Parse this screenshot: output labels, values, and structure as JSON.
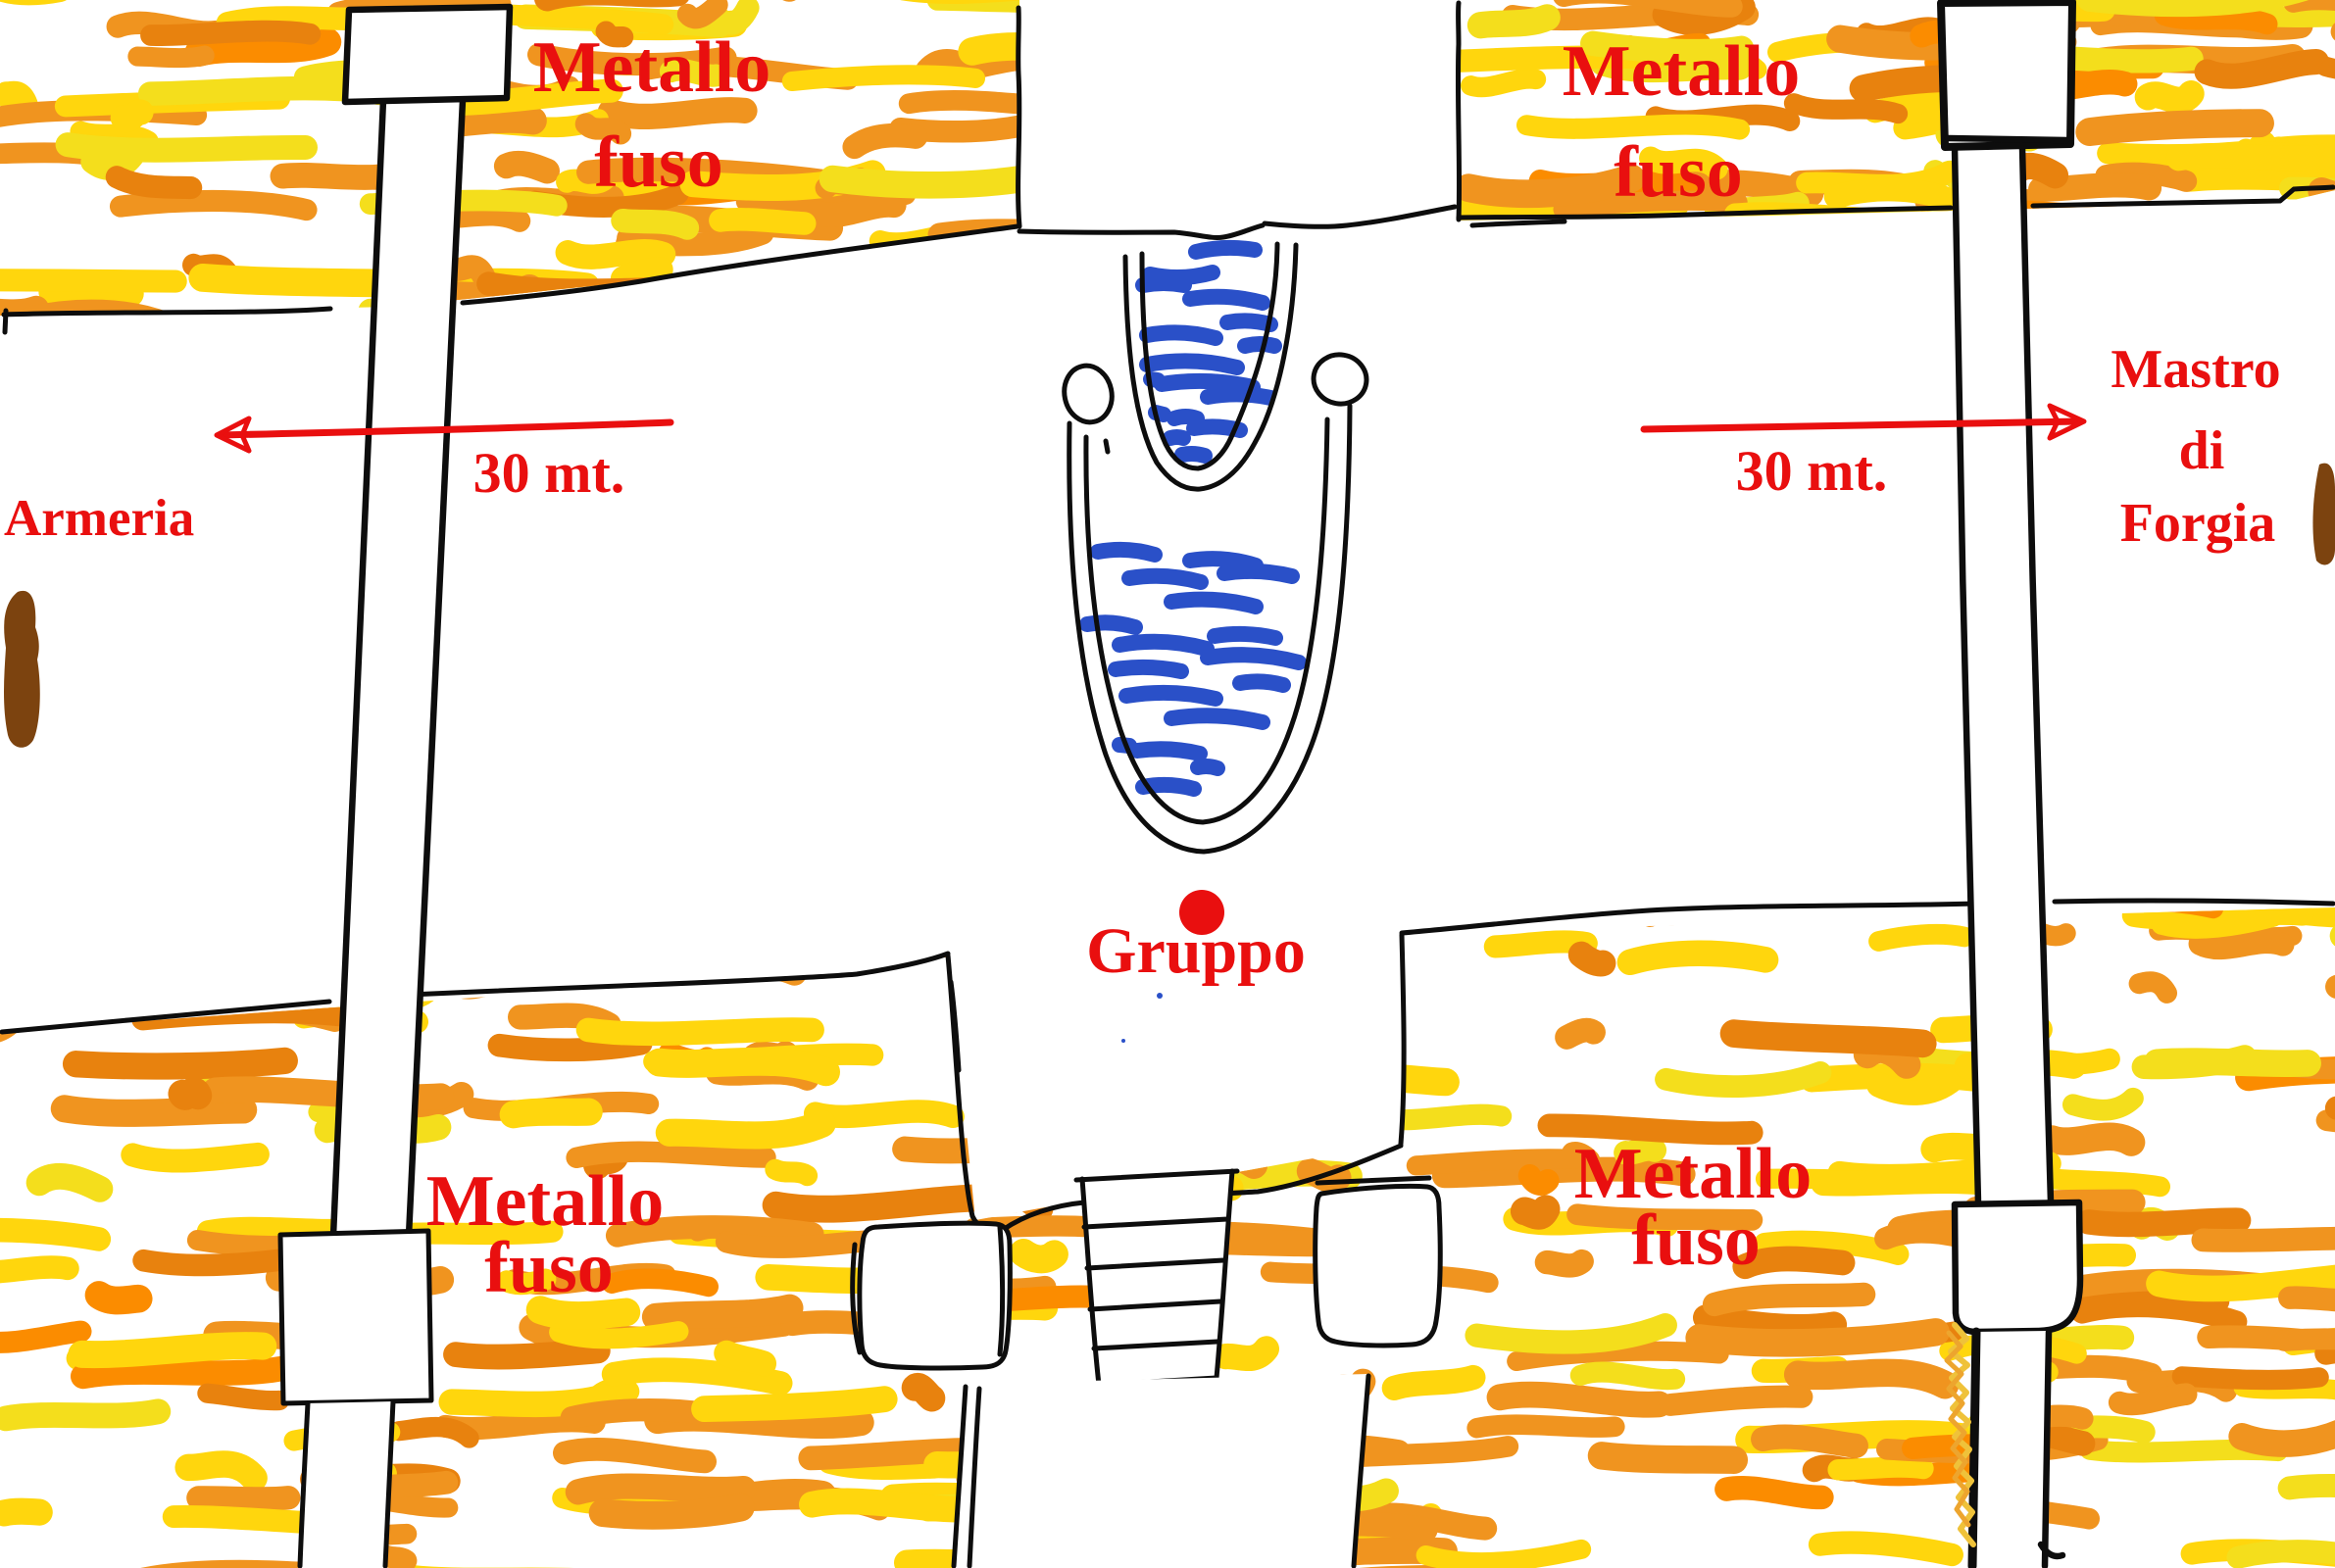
{
  "map": {
    "molten_label": {
      "line1": "Metallo",
      "line2": "fuso"
    },
    "armory_label": "Armeria",
    "forge_master_label": {
      "line1": "Mastro",
      "line2": "di",
      "line3": "Forgia"
    },
    "group_label": "Gruppo",
    "annotations": {
      "distance_left": {
        "label": "30 mt.",
        "arrow_direction": "left"
      },
      "distance_right": {
        "label": "30 mt.",
        "arrow_direction": "right"
      }
    }
  },
  "colors": {
    "molten_orange": "#F0941F",
    "molten_orange_deep": "#E8820E",
    "molten_orange_bright": "#FB8C00",
    "molten_yellow": "#FFD60D",
    "molten_yellow_pale": "#F4DE1C",
    "water_blue": "#2A50C8",
    "annotation_red": "#E90F0F",
    "door_brown": "#7C430F",
    "ink_black": "#0D0D0D"
  }
}
